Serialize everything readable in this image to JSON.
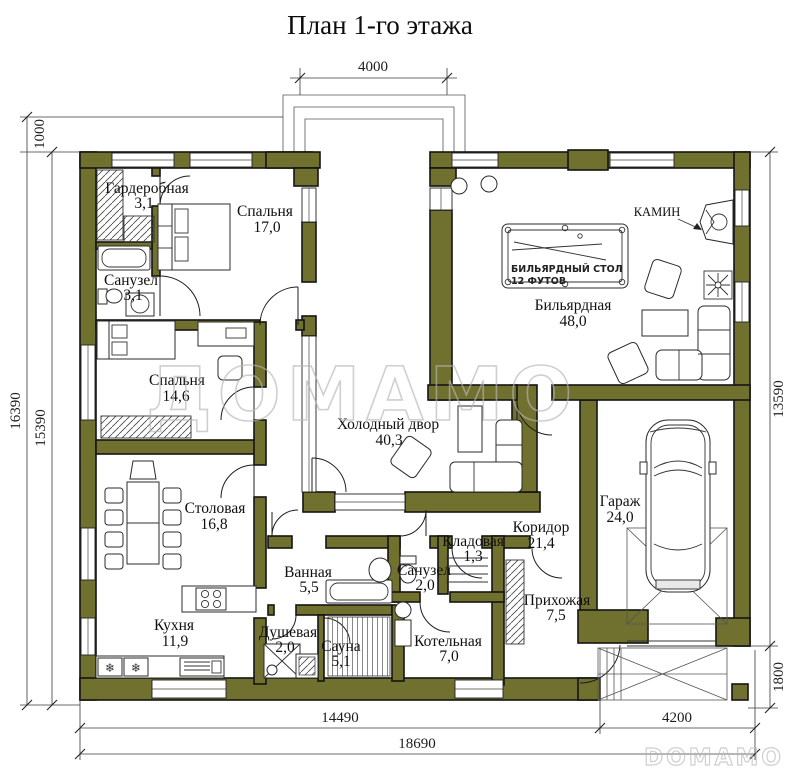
{
  "title": "План 1-го этажа",
  "colors": {
    "wall": "#70702f",
    "outline": "#141414",
    "watermark": "#b6b6b6"
  },
  "rooms": [
    {
      "id": "garderobnaya",
      "name": "Гардеробная",
      "area": "3,1"
    },
    {
      "id": "spalnya-1",
      "name": "Спальня",
      "area": "17,0"
    },
    {
      "id": "sanuzel-1",
      "name": "Санузел",
      "area": "3,1"
    },
    {
      "id": "spalnya-2",
      "name": "Спальня",
      "area": "14,6"
    },
    {
      "id": "holodny-dvor",
      "name": "Холодный двор",
      "area": "40,3"
    },
    {
      "id": "bilyardnaya",
      "name": "Бильярдная",
      "area": "48,0"
    },
    {
      "id": "stolovaya",
      "name": "Столовая",
      "area": "16,8"
    },
    {
      "id": "kuhnya",
      "name": "Кухня",
      "area": "11,9"
    },
    {
      "id": "vannaya",
      "name": "Ванная",
      "area": "5,5"
    },
    {
      "id": "sanuzel-2",
      "name": "Санузел",
      "area": "2,0"
    },
    {
      "id": "kladovaya",
      "name": "Кладовая",
      "area": "1,3"
    },
    {
      "id": "koridor",
      "name": "Коридор",
      "area": "21,4"
    },
    {
      "id": "dushevaya",
      "name": "Душевая",
      "area": "2,0"
    },
    {
      "id": "sauna",
      "name": "Сауна",
      "area": "5,1"
    },
    {
      "id": "kotelnaya",
      "name": "Котельная",
      "area": "7,0"
    },
    {
      "id": "prihozhaya",
      "name": "Прихожая",
      "area": "7,5"
    },
    {
      "id": "garazh",
      "name": "Гараж",
      "area": "24,0"
    }
  ],
  "annotations": {
    "fireplace": "КАМИН",
    "billiard_line1": "БИЛЬЯРДНЫЙ СТОЛ",
    "billiard_line2": "12 ФУТОВ"
  },
  "dimensions": {
    "top": "4000",
    "left_top": "1000",
    "left_outer": "16390",
    "left_inner": "15390",
    "right_main": "13590",
    "right_lower": "1800",
    "bottom_left": "14490",
    "bottom_right": "4200",
    "bottom_total": "18690"
  },
  "watermark": {
    "center": "ДОМАМО",
    "corner": "DOMAMO"
  }
}
